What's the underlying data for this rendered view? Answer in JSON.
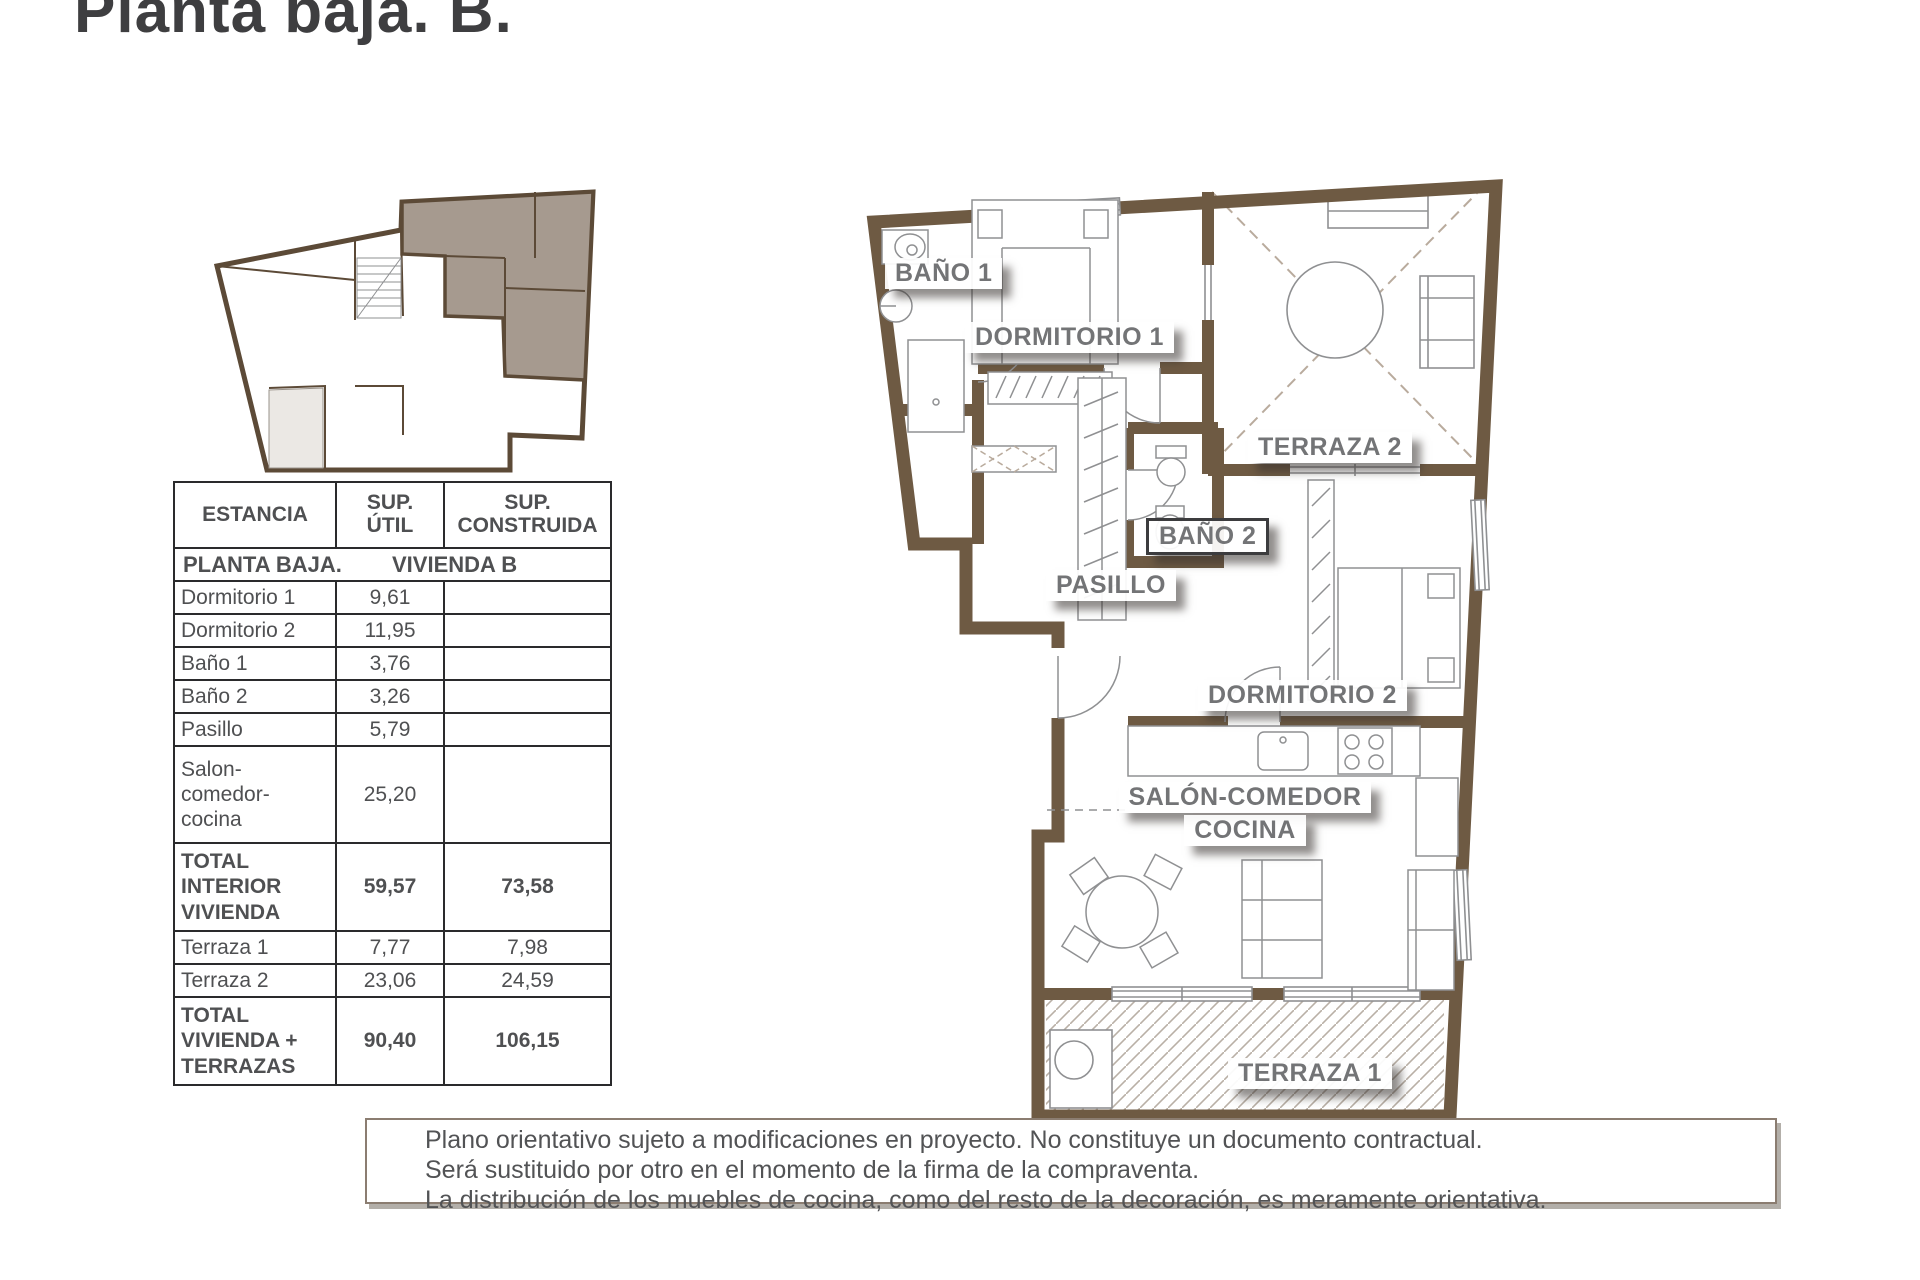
{
  "page": {
    "title": "Planta baja. B."
  },
  "table": {
    "headers": {
      "estancia": "ESTANCIA",
      "util": "SUP.\nÚTIL",
      "construida": "SUP.\nCONSTRUIDA"
    },
    "section": {
      "left": "PLANTA BAJA.",
      "right": "VIVIENDA B"
    },
    "rows": [
      {
        "name": "Dormitorio 1",
        "util": "9,61",
        "construida": "",
        "bold": false
      },
      {
        "name": "Dormitorio 2",
        "util": "11,95",
        "construida": "",
        "bold": false
      },
      {
        "name": "Baño 1",
        "util": "3,76",
        "construida": "",
        "bold": false
      },
      {
        "name": "Baño 2",
        "util": "3,26",
        "construida": "",
        "bold": false
      },
      {
        "name": "Pasillo",
        "util": "5,79",
        "construida": "",
        "bold": false
      },
      {
        "name": "Salon-\ncomedor-\ncocina",
        "util": "25,20",
        "construida": "",
        "bold": false
      },
      {
        "name": "TOTAL\nINTERIOR\nVIVIENDA",
        "util": "59,57",
        "construida": "73,58",
        "bold": true
      },
      {
        "name": "Terraza 1",
        "util": "7,77",
        "construida": "7,98",
        "bold": false
      },
      {
        "name": "Terraza 2",
        "util": "23,06",
        "construida": "24,59",
        "bold": false
      },
      {
        "name": "TOTAL\nVIVIENDA +\nTERRAZAS",
        "util": "90,40",
        "construida": "106,15",
        "bold": true
      }
    ]
  },
  "plan": {
    "labels": {
      "bano1": "BAÑO 1",
      "dormitorio1": "DORMITORIO 1",
      "terraza2": "TERRAZA 2",
      "bano2": "BAÑO 2",
      "pasillo": "PASILLO",
      "dormitorio2": "DORMITORIO 2",
      "salon_line1": "SALÓN-COMEDOR",
      "salon_line2": "COCINA",
      "terraza1": "TERRAZA 1"
    }
  },
  "disclaimer": {
    "lines": [
      "Plano orientativo sujeto a modificaciones en proyecto. No constituye un documento contractual.",
      "Será sustituido por otro en el momento de la firma de la compraventa.",
      "La distribución de los muebles de cocina, como del resto de la decoración, es meramente orientativa."
    ]
  },
  "colors": {
    "wall": "#6e5a43",
    "mini_wall": "#5c4a37",
    "highlight_unit": "#a69a8f",
    "furniture_line": "#8f9092",
    "dashed_line": "#b9ab9d",
    "label_text": "#737476"
  }
}
